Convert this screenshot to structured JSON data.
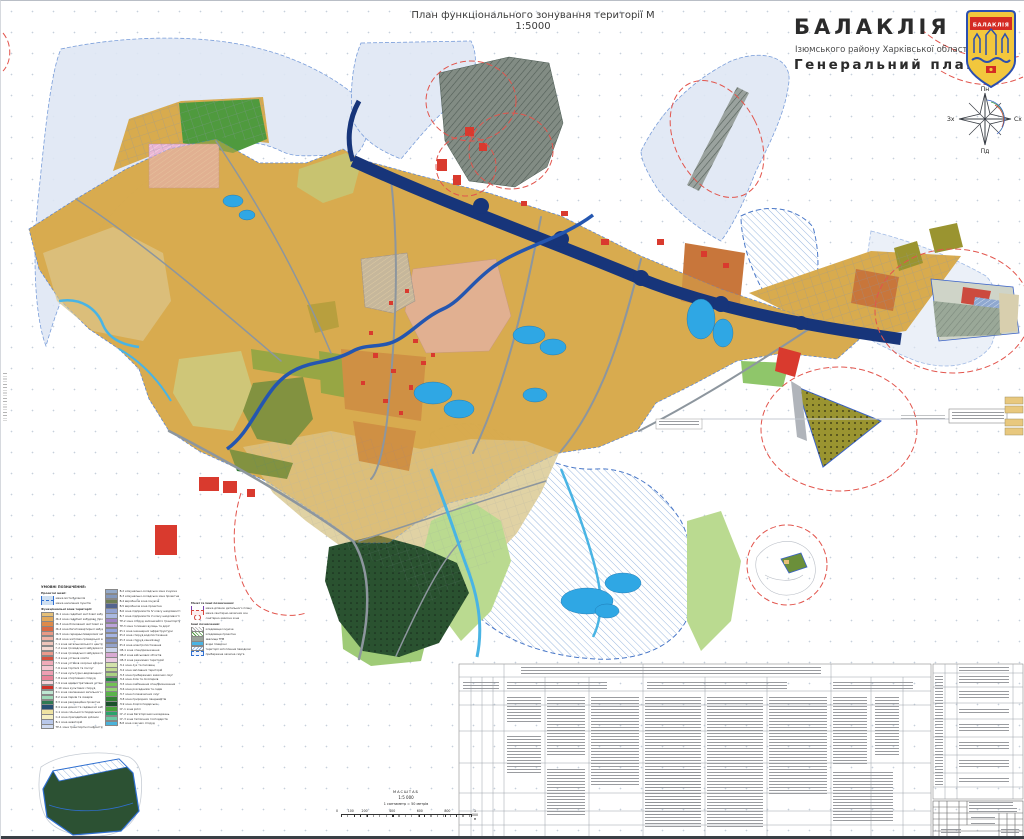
{
  "sheet": {
    "map_title": "План функціонального зонування території М 1:5000",
    "city_title": "БАЛАКЛІЯ",
    "city_subtitle": "Ізюмського району Харківської області",
    "plan_title": "Генеральний план",
    "crest_label": "БАЛАКЛІЯ"
  },
  "compass": {
    "north": "Пн",
    "south": "Пд",
    "east": "Сх",
    "west": "Зх"
  },
  "legend": {
    "title": "УМОВНІ ПОЗНАЧЕННЯ:",
    "boundaries_header": "Проектні межі:",
    "boundary_items": [
      {
        "label": "межа міста Балаклія"
      },
      {
        "label": "межа населених пунктів"
      }
    ],
    "zones_header": "Функціональні зони території:",
    "col1": [
      {
        "color": "#e6c078",
        "label": "Ж-1 зона садибної житлової забудови"
      },
      {
        "color": "#e3a95c",
        "label": "Ж-2 зона садибної забудови (проектна)"
      },
      {
        "color": "#dd8a4a",
        "label": "Ж-3 зона блокованої житлової забудови"
      },
      {
        "color": "#d96a45",
        "label": "Ж-4 зона багатоквартирної забудови"
      },
      {
        "color": "#e89a86",
        "label": "Ж-5 зона середньоповерхової забудови"
      },
      {
        "color": "#f0b3a6",
        "label": "Ж-6 зона житлово-громадської забудови"
      },
      {
        "color": "#eec4ba",
        "label": "Г-1 зона загальноміського центру"
      },
      {
        "color": "#f4d7d0",
        "label": "Г-2 зона громадської забудови існуюча"
      },
      {
        "color": "#ea9a8c",
        "label": "Г-3 зона громадської забудови проектна"
      },
      {
        "color": "#d7513f",
        "label": "Г-4 зона установ освіти"
      },
      {
        "color": "#f0aab9",
        "label": "Г-5 зона установ охорони здоров'я"
      },
      {
        "color": "#f4c6d1",
        "label": "Г-6 зона торгівлі та послуг"
      },
      {
        "color": "#ee9fb3",
        "label": "Г-7 зона культурно-видовищних установ"
      },
      {
        "color": "#e88398",
        "label": "Г-8 зона спортивних споруд"
      },
      {
        "color": "#f6d3da",
        "label": "Г-9 зона адміністративних установ"
      },
      {
        "color": "#d02f26",
        "label": "Г-10 зона культових споруд"
      },
      {
        "color": "#bfe7d2",
        "label": "Р-1 зона озеленення загального користування"
      },
      {
        "color": "#9ed9b7",
        "label": "Р-2 зона парків та скверів"
      },
      {
        "color": "#2f7a52",
        "label": "Р-3 зона рекреаційна проектна"
      },
      {
        "color": "#274f73",
        "label": "Р-4 зона дачної та садівничої забудови"
      },
      {
        "color": "#efe3a2",
        "label": "С-1 зона сільськогосподарських угідь"
      },
      {
        "color": "#f5efc2",
        "label": "С-2 зона присадибних ділянок"
      },
      {
        "color": "#b9c8ea",
        "label": "В-1 зона акваторій"
      },
      {
        "color": "#cfdaf0",
        "label": "ТР-1 зона транспортної інфраструктури"
      }
    ],
    "col2": [
      {
        "color": "#93a9c9",
        "label": "В-2 комунально-складська зона існуюча"
      },
      {
        "color": "#8398bd",
        "label": "В-3 комунально-складська зона проектна"
      },
      {
        "color": "#6e7f55",
        "label": "В-4 виробнича зона існуюча"
      },
      {
        "color": "#53648f",
        "label": "В-5 виробнича зона проектна"
      },
      {
        "color": "#93a3d2",
        "label": "В-6 зона підприємств IV класу шкідливості"
      },
      {
        "color": "#aab9e1",
        "label": "В-7 зона підприємств V класу шкідливості"
      },
      {
        "color": "#a184c4",
        "label": "ТР-2 зона споруд залізничного транспорту"
      },
      {
        "color": "#bba3da",
        "label": "ТР-3 зона головних вулиць та доріг"
      },
      {
        "color": "#93a3da",
        "label": "ІН-1 зона інженерної інфраструктури"
      },
      {
        "color": "#a4b3e2",
        "label": "ІН-2 зона споруд водопостачання"
      },
      {
        "color": "#8492c3",
        "label": "ІН-3 зона споруд каналізації"
      },
      {
        "color": "#94a3cb",
        "label": "ІН-4 зона електропостачання"
      },
      {
        "color": "#cbd3ea",
        "label": "СВ-1 зона спецпризначення"
      },
      {
        "color": "#d9aad3",
        "label": "СВ-2 зона військових об'єктів"
      },
      {
        "color": "#ebcbe2",
        "label": "СВ-3 зона режимних територій"
      },
      {
        "color": "#d3e2ab",
        "label": "Л-1 зона лук та пасовищ"
      },
      {
        "color": "#c3da93",
        "label": "Л-2 зона заплавних територій"
      },
      {
        "color": "#abd283",
        "label": "Л-3 зона прибережних захисних смуг"
      },
      {
        "color": "#238243",
        "label": "Л-4 зона лісів та лісопарків"
      },
      {
        "color": "#72c253",
        "label": "Л-5 зона озеленення спецпризначення"
      },
      {
        "color": "#93d273",
        "label": "Л-6 зона розсадників та садів"
      },
      {
        "color": "#5ab34b",
        "label": "Л-7 зона полезахисних смуг"
      },
      {
        "color": "#328233",
        "label": "Л-8 зона природних ландшафтів"
      },
      {
        "color": "#1b522b",
        "label": "Л-9 зона лісогосподарська"
      },
      {
        "color": "#4aa23b",
        "label": "СГ-1 зона ріллі"
      },
      {
        "color": "#2ba36b",
        "label": "СГ-2 зона багаторічних насаджень"
      },
      {
        "color": "#6bcaa3",
        "label": "СГ-3 зона тепличних господарств"
      },
      {
        "color": "#4ab3da",
        "label": "В-8 зона очисних споруд"
      }
    ],
    "col3_header": "Межі та інші позначення:",
    "col3_sub_header": "Інші позначення:",
    "col3_top": [
      {
        "icon": "dash-purple",
        "label": "межа ділянок детального плану"
      },
      {
        "icon": "dash-red",
        "label": "межа санітарно-захисних зон"
      },
      {
        "icon": "circle-red",
        "label": "санітарно-захисна зона"
      }
    ],
    "col3_bottom": [
      {
        "icon": "hatch-gray",
        "label": "кладовище існуюче"
      },
      {
        "icon": "hatch-green",
        "label": "кладовище проектне"
      },
      {
        "icon": "solid-gray",
        "label": "звалище ТПВ"
      },
      {
        "icon": "solid-blue",
        "label": "водні поверхні"
      },
      {
        "icon": "hatch-blue",
        "label": "території затоплення паводком"
      },
      {
        "icon": "dash-blue",
        "label": "прибережна захисна смуга"
      }
    ]
  },
  "scalebar": {
    "title": "МАСШТАБ",
    "ratio": "1:5 000",
    "note": "1 сантиметр = 50 метрів",
    "unit_labels": [
      "0",
      "100",
      "200",
      "400",
      "600",
      "800",
      "1 000 м"
    ]
  },
  "map_colors": {
    "residential": "#d8ab4e",
    "river": "#17357a",
    "ponds": "#2fa7e4",
    "industrial": "#828c84",
    "public_orange": "#c8763b",
    "parks": "#2f7a33",
    "meadows": "#bada90",
    "agriculture": "#e0d2a4",
    "forest": "#2a5230",
    "sanitary_boundary": "#e2554d",
    "floodplain_boundary": "#4a78c8",
    "pink_zone": "#eab6d4",
    "periwinkle_zone": "#b6c3e6",
    "olive_zone": "#9a9430"
  }
}
